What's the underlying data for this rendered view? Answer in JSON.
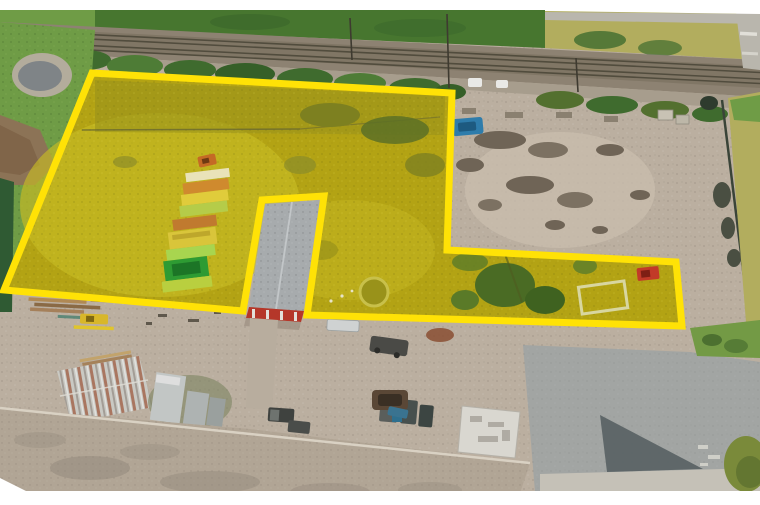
{
  "image": {
    "kind": "aerial-drone-photograph",
    "subject": "industrial property with a land parcel highlighted by a yellow boundary overlay",
    "width_px": 760,
    "height_px": 505,
    "visible_text": []
  },
  "annotation": {
    "boundary_color": "#ffe206",
    "boundary_stroke_px": 7,
    "parcel_outline_points": "92,73 452,93 447,250 676,262 682,326 307,315 324,196 262,200 243,311 4,290",
    "note": "polygon excludes the gray-roof building via a notch"
  },
  "palette": {
    "frame": "#ffffff",
    "boundary": "#ffe206",
    "parcelBase": "#b3a314",
    "parcelLight": "#c8bb24",
    "parcelDark": "#99921a",
    "parcelTexDark": "#6d6a10",
    "parcelTexLight": "#e0d84a",
    "grass": "#6f9c46",
    "grassDark": "#3f6b2e",
    "corn": "#47762f",
    "fieldOlive": "#b2ad5e",
    "roadTop": "#b9b6ad",
    "ballast": "#8d8272",
    "ballastDark": "#7a7060",
    "rail": "#514c3d",
    "verge": "#a79d8d",
    "pondWater": "#7f8487",
    "pondRing": "#b3ac9c",
    "dirtMound": "#8c7356",
    "hedge": "#2f5a33",
    "shrubOlive": "#7d8020",
    "treeDark": "#4a6b24",
    "gravel": "#bbafa0",
    "gravelLight": "#c9beae",
    "debris": "#6f6456",
    "debrisLight": "#8a8070",
    "fence": "#3a4438",
    "blueMachine": "#2e7cab",
    "tarp": "#e9e9e6",
    "frameStruct": "#d8d6a0",
    "mowerRed": "#c23a28",
    "roofGray": "#a7abad",
    "roofRidge": "#c6cacc",
    "redWall": "#b5372a",
    "contPale": "#e9e2b8",
    "contOrange": "#cf8a2e",
    "contYellow": "#e0cc3b",
    "contYG": "#b5cc49",
    "contOrange2": "#c07a2f",
    "contMottled": "#d9c53a",
    "contLGreen": "#a8d54f",
    "contGreen": "#2e9b33",
    "contGreenDark": "#1c7526",
    "whRoof": "#c9c9c3",
    "rust": "#9e5b3f",
    "lumber": "#b08954",
    "trailerGray": "#c2c6c5",
    "moss": "#7b8460",
    "bigRoof": "#b1a595",
    "bigRoofEdge": "#d9d1c3",
    "bigRoofSmudge": "#8e8478",
    "truckDark": "#3f423f",
    "padWhite": "#d9d7d0",
    "padMark": "#a8a49c",
    "asphalt": "#a2a5a3",
    "shadow": "#586063",
    "concrete": "#c5c1b7",
    "grassMound": "#7a8a3a",
    "pole": "#3e3a30",
    "pitBrown": "#5a4736",
    "teal": "#4a7f6f",
    "machineYellow": "#d8b72a"
  },
  "scene_features": [
    {
      "name": "railway-tracks",
      "label": "double railway line crossing top of frame"
    },
    {
      "name": "rail-crossing-road",
      "label": "small road crossing the tracks top right"
    },
    {
      "name": "cornfield",
      "label": "green crop field above the tracks"
    },
    {
      "name": "pond",
      "label": "small gray pond upper left"
    },
    {
      "name": "highlighted-parcel",
      "label": "grassy parcel tinted yellow with bright yellow boundary"
    },
    {
      "name": "container-stacks",
      "label": "rows of orange / yellow / green containers inside parcel"
    },
    {
      "name": "excluded-building",
      "label": "gray-roof building with red south wall, cut out of parcel"
    },
    {
      "name": "gravel-yard",
      "label": "gravel yard with scrap piles right of parcel"
    },
    {
      "name": "blue-machine",
      "label": "small blue machine at yard edge"
    },
    {
      "name": "red-mower",
      "label": "red vehicle in east strip of parcel"
    },
    {
      "name": "warehouse",
      "label": "rust-streaked metal warehouse lower left"
    },
    {
      "name": "trailers",
      "label": "gray trailers parked beside warehouse"
    },
    {
      "name": "large-roof",
      "label": "large tan industrial roof across bottom"
    },
    {
      "name": "white-pad-building",
      "label": "small white flat roof structure bottom center-right"
    },
    {
      "name": "access-road",
      "label": "gray asphalt apron bottom right"
    },
    {
      "name": "building-shadow",
      "label": "dark shadow cast on asphalt"
    }
  ]
}
